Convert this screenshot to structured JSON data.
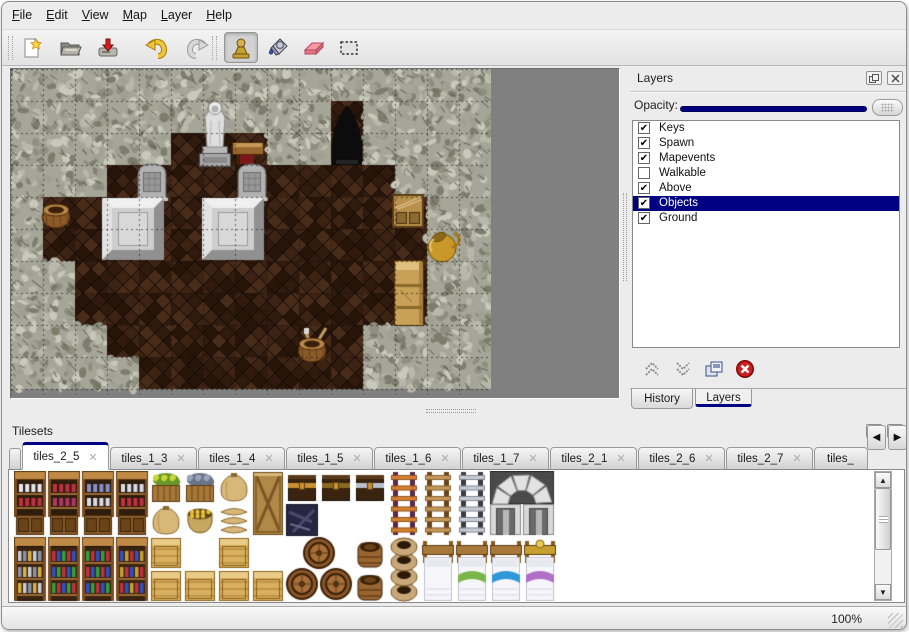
{
  "menu": {
    "items": [
      {
        "label": "File"
      },
      {
        "label": "Edit"
      },
      {
        "label": "View"
      },
      {
        "label": "Map"
      },
      {
        "label": "Layer"
      },
      {
        "label": "Help"
      }
    ]
  },
  "toolbar": {
    "icons": [
      "new-document",
      "open-folder",
      "save",
      "undo",
      "redo",
      "stamp-tool",
      "fill-tool",
      "eraser-tool",
      "select-tool"
    ],
    "selected_tool": "stamp-tool"
  },
  "layers_panel": {
    "title": "Layers",
    "window_icons": [
      "float-icon",
      "close-icon"
    ],
    "opacity_label": "Opacity:",
    "opacity_fraction": 1,
    "items": [
      {
        "label": "Keys",
        "checked": true,
        "selected": false
      },
      {
        "label": "Spawn",
        "checked": true,
        "selected": false
      },
      {
        "label": "Mapevents",
        "checked": true,
        "selected": false
      },
      {
        "label": "Walkable",
        "checked": false,
        "selected": false
      },
      {
        "label": "Above",
        "checked": true,
        "selected": false
      },
      {
        "label": "Objects",
        "checked": true,
        "selected": true
      },
      {
        "label": "Ground",
        "checked": true,
        "selected": false
      }
    ],
    "tools": [
      "move-layer-up",
      "move-layer-down",
      "duplicate-layer",
      "delete-layer"
    ],
    "tabs": [
      {
        "label": "History",
        "active": false
      },
      {
        "label": "Layers",
        "active": true
      }
    ]
  },
  "tilesets_panel": {
    "title": "Tilesets",
    "window_icons": [
      "float-icon",
      "close-icon"
    ],
    "tabs": [
      {
        "label": "tiles_2_5",
        "active": true,
        "closable": true,
        "partial": false
      },
      {
        "label": "tiles_1_3",
        "active": false,
        "closable": true,
        "partial": false
      },
      {
        "label": "tiles_1_4",
        "active": false,
        "closable": true,
        "partial": false
      },
      {
        "label": "tiles_1_5",
        "active": false,
        "closable": true,
        "partial": false
      },
      {
        "label": "tiles_1_6",
        "active": false,
        "closable": true,
        "partial": false
      },
      {
        "label": "tiles_1_7",
        "active": false,
        "closable": true,
        "partial": false
      },
      {
        "label": "tiles_2_1",
        "active": false,
        "closable": true,
        "partial": false
      },
      {
        "label": "tiles_2_6",
        "active": false,
        "closable": true,
        "partial": false
      },
      {
        "label": "tiles_2_7",
        "active": false,
        "closable": true,
        "partial": false
      },
      {
        "label": "tiles_",
        "active": false,
        "closable": false,
        "partial": true
      }
    ],
    "scroll_arrows": {
      "left": "◀",
      "right": "▶"
    },
    "vscroll_arrows": {
      "up": "▲",
      "down": "▼"
    }
  },
  "status": {
    "zoom": "100%"
  },
  "colors": {
    "accent_navy": "#000082",
    "map_background": "#808080",
    "wall_base": "#a6a698",
    "floor_base": "#20120a",
    "delete_red": "#cc1f1f"
  },
  "map": {
    "tile_size": 32,
    "grid": [
      "###############",
      "##########D####",
      "#####...##D####",
      "###.........###",
      "#............##",
      "#............##",
      "##...........##",
      "##...........##",
      "###........####",
      "####.......####"
    ],
    "objects": [
      {
        "t": "statue",
        "x": 187,
        "y": 28
      },
      {
        "t": "table",
        "x": 221,
        "y": 69
      },
      {
        "t": "grave",
        "x": 127,
        "y": 95
      },
      {
        "t": "grave",
        "x": 227,
        "y": 95
      },
      {
        "t": "altar",
        "x": 91,
        "y": 129
      },
      {
        "t": "altar",
        "x": 191,
        "y": 129
      },
      {
        "t": "basket",
        "x": 31,
        "y": 131
      },
      {
        "t": "crateshelf",
        "x": 381,
        "y": 125
      },
      {
        "t": "goldpot",
        "x": 415,
        "y": 159
      },
      {
        "t": "cabinet",
        "x": 383,
        "y": 191
      },
      {
        "t": "toolbasket",
        "x": 287,
        "y": 261
      }
    ]
  },
  "tileset_items": [
    {
      "t": "shelf",
      "x": 0,
      "y": 0,
      "c": [
        "#e8e8f0",
        "#c03040"
      ]
    },
    {
      "t": "shelf",
      "x": 34,
      "y": 0,
      "c": [
        "#c03040",
        "#b03868"
      ]
    },
    {
      "t": "shelf",
      "x": 68,
      "y": 0,
      "c": [
        "#8890c8",
        "#d8dce8"
      ]
    },
    {
      "t": "shelf",
      "x": 102,
      "y": 0,
      "c": [
        "#d8dce8",
        "#c03040"
      ]
    },
    {
      "t": "crate_plant",
      "x": 136,
      "y": 0,
      "c": [
        "#c8d838",
        "#6a9828"
      ]
    },
    {
      "t": "crate_plant",
      "x": 170,
      "y": 0,
      "c": [
        "#9aa4b8",
        "#6a7488"
      ]
    },
    {
      "t": "sack",
      "x": 204,
      "y": 0,
      "c": []
    },
    {
      "t": "crate_x",
      "x": 238,
      "y": 0,
      "c": []
    },
    {
      "t": "chest",
      "x": 272,
      "y": 0,
      "c": [
        "#c89030"
      ]
    },
    {
      "t": "chest",
      "x": 306,
      "y": 0,
      "c": [
        "#8a6a20"
      ]
    },
    {
      "t": "chest",
      "x": 340,
      "y": 0,
      "c": [
        "#b8c0cc"
      ]
    },
    {
      "t": "ladder",
      "x": 374,
      "y": 0,
      "c": [
        "#d88030",
        "#5a2848"
      ]
    },
    {
      "t": "ladder",
      "x": 408,
      "y": 0,
      "c": [
        "#c89858",
        "#6a4418"
      ]
    },
    {
      "t": "ladder",
      "x": 442,
      "y": 0,
      "c": [
        "#c8ccd8",
        "#3a3a42"
      ]
    },
    {
      "t": "arch",
      "x": 476,
      "y": 0,
      "c": []
    },
    {
      "t": "sack",
      "x": 136,
      "y": 33,
      "c": []
    },
    {
      "t": "sack_gold",
      "x": 170,
      "y": 33,
      "c": []
    },
    {
      "t": "sack_pile",
      "x": 204,
      "y": 33,
      "c": []
    },
    {
      "t": "debris",
      "x": 272,
      "y": 33,
      "c": []
    },
    {
      "t": "shelf_tall",
      "x": 0,
      "y": 66,
      "c": [
        "#c8ccd8",
        "#8a93a8",
        "#d8b048"
      ]
    },
    {
      "t": "shelf_tall",
      "x": 34,
      "y": 66,
      "c": [
        "#c03040",
        "#3050c8",
        "#30a040"
      ]
    },
    {
      "t": "shelf_tall",
      "x": 68,
      "y": 66,
      "c": [
        "#30a040",
        "#c03040",
        "#3050c8"
      ]
    },
    {
      "t": "shelf_tall",
      "x": 102,
      "y": 66,
      "c": [
        "#3050c8",
        "#c8a030",
        "#c03040"
      ]
    },
    {
      "t": "crate_gold",
      "x": 136,
      "y": 66,
      "c": []
    },
    {
      "t": "crate_gold",
      "x": 204,
      "y": 66,
      "c": []
    },
    {
      "t": "crate_gold",
      "x": 136,
      "y": 99,
      "c": []
    },
    {
      "t": "crate_gold",
      "x": 170,
      "y": 99,
      "c": []
    },
    {
      "t": "crate_gold",
      "x": 204,
      "y": 99,
      "c": []
    },
    {
      "t": "crate_gold",
      "x": 238,
      "y": 99,
      "c": []
    },
    {
      "t": "barrels3",
      "x": 272,
      "y": 66,
      "c": []
    },
    {
      "t": "barrel",
      "x": 340,
      "y": 66,
      "c": []
    },
    {
      "t": "barrel",
      "x": 340,
      "y": 99,
      "c": []
    },
    {
      "t": "pots",
      "x": 374,
      "y": 66,
      "c": []
    },
    {
      "t": "bed",
      "x": 408,
      "y": 66,
      "c": [
        ""
      ]
    },
    {
      "t": "bed",
      "x": 442,
      "y": 66,
      "c": [
        "#7ab648"
      ]
    },
    {
      "t": "bed",
      "x": 476,
      "y": 66,
      "c": [
        "#3098d8"
      ]
    },
    {
      "t": "bed",
      "x": 510,
      "y": 66,
      "c": [
        "#b070c8"
      ],
      "fancy": true
    }
  ]
}
